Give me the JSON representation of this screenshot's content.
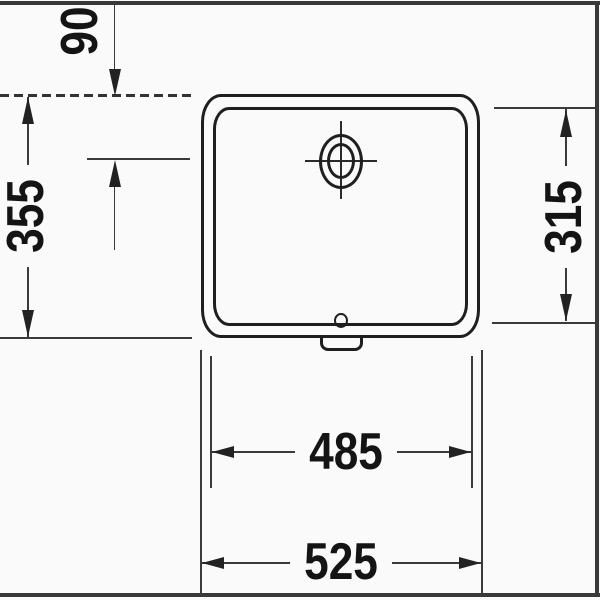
{
  "drawing": {
    "dimensions": {
      "drain_center_offset": "90",
      "overall_depth": "355",
      "basin_inner_depth": "315",
      "basin_inner_width": "485",
      "overall_width": "525"
    },
    "colors": {
      "line": "#1f1f1f",
      "dimension_line": "#3a3a3a",
      "text": "#141414",
      "background": "#fafafa"
    }
  }
}
